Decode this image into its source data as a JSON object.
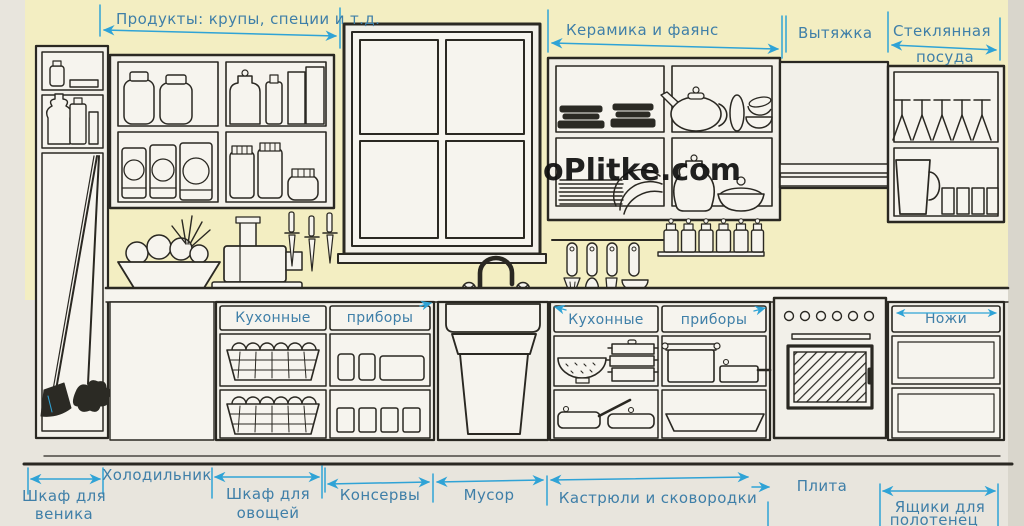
{
  "diagram": {
    "watermark": "oPlitke.com",
    "wall_labels": {
      "products": "Продукты: крупы, специи и т.д.",
      "ceramics": "Керамика и фаянс",
      "hood": "Вытяжка",
      "glassware_line1": "Стеклянная",
      "glassware_line2": "посуда"
    },
    "cabinet_labels": {
      "left_kitchen": "Кухонные",
      "left_utensils": "приборы",
      "right_kitchen": "Кухонные",
      "right_utensils": "приборы",
      "knives": "Ножи"
    },
    "floor_labels": {
      "broom_line1": "Шкаф для",
      "broom_line2": "веника",
      "fridge": "Холодильник",
      "vegetables_line1": "Шкаф для",
      "vegetables_line2": "овощей",
      "canned_goods": "Консервы",
      "trash": "Мусор",
      "pots_pans": "Кастрюли и сковородки",
      "stove": "Плита",
      "towels_line1": "Ящики для",
      "towels_line2": "полотенец"
    },
    "colors": {
      "wall": "#f3eec2",
      "paper": "#e8e5dd",
      "ink": "#2a2822",
      "annotation": "#2fa3d6",
      "annotation_text": "#3f7fa8"
    }
  }
}
